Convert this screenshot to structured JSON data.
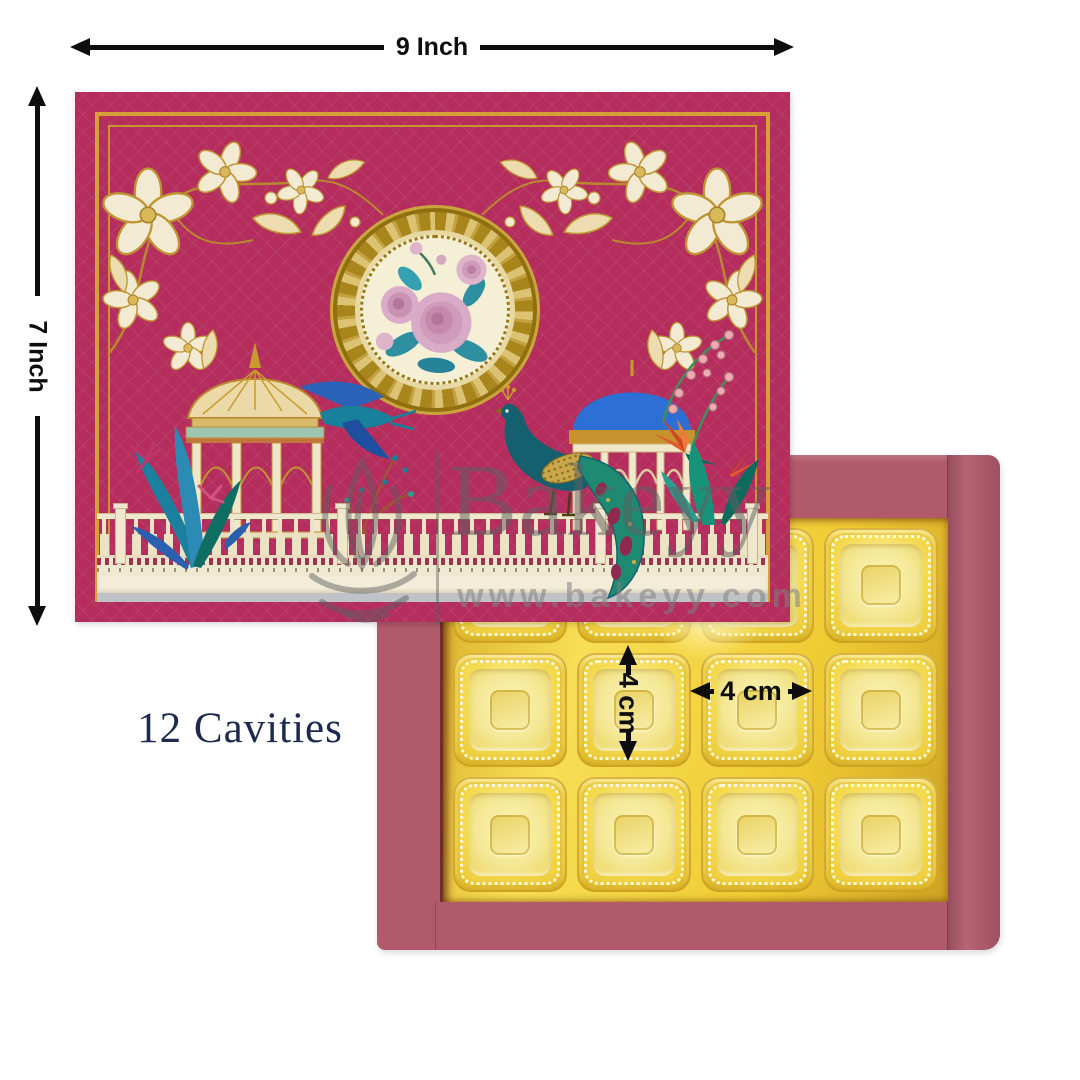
{
  "page": {
    "background": "#ffffff"
  },
  "annotations": {
    "width": {
      "label": "9 Inch"
    },
    "height": {
      "label": "7 Inch"
    },
    "cavity_width": {
      "label": "4 cm"
    },
    "cavity_height": {
      "label": "4 cm"
    },
    "cavity_count": {
      "label": "12 Cavities"
    }
  },
  "watermark": {
    "brand": "Bakeyy",
    "website": "www.bakeyy.com",
    "logo": "lotus-leaf-logo"
  },
  "box": {
    "lid": {
      "color": "#b42d5c",
      "border_gold": "#d79f38",
      "art": [
        "floral-corner-left",
        "floral-corner-right",
        "rose-medallion",
        "gold-dome-gazebo",
        "blue-dome-gazebo",
        "blue-bird",
        "peacock",
        "tropical-plants",
        "coral-flowers",
        "balustrade-fence"
      ]
    },
    "base": {
      "color": "#b15a6b",
      "tray_gold": "#f0cc34",
      "cavities": {
        "count": 12,
        "rows": 3,
        "cols": 4
      }
    }
  },
  "colors": {
    "annotation_black": "#0d0d0d",
    "count_text_navy": "#1c2b4d",
    "dome_blue": "#2e6fd6",
    "peacock_teal": "#15606f",
    "cream": "#f2ead2",
    "watermark_gray": "#8c8c8c"
  }
}
